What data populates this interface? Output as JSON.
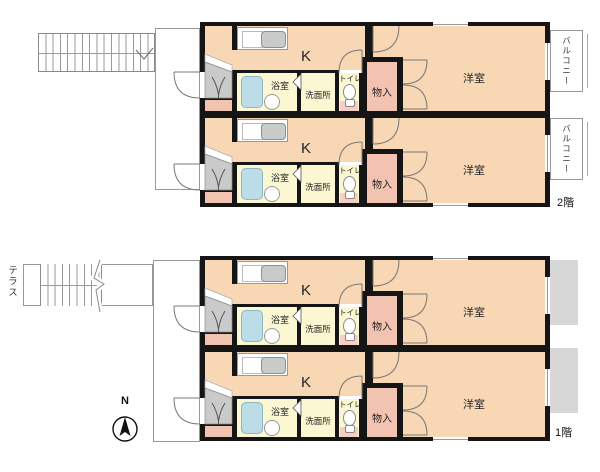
{
  "title": "apartment floor plan",
  "unit_labels": {
    "entrance": "玄関",
    "bath": "浴室",
    "washroom": "洗面所",
    "toilet": "トイレ",
    "storage": "物入",
    "kitchen": "K",
    "western_room": "洋室"
  },
  "floors": {
    "second": {
      "label": "2階",
      "balcony_label": "バルコニー"
    },
    "first": {
      "label": "1階",
      "terrace_label": "テラス",
      "compass_label": "N"
    }
  },
  "colors": {
    "wall": "#151515",
    "room_peach": "#F8D7B4",
    "service_yellow": "#FAF7D2",
    "storage_pink": "#F3C3B2",
    "entrance_gray": "#CACACA",
    "tub_blue": "#BCDCE8",
    "terrace_gray": "#D7D7D7",
    "outline_gray": "#999999"
  }
}
